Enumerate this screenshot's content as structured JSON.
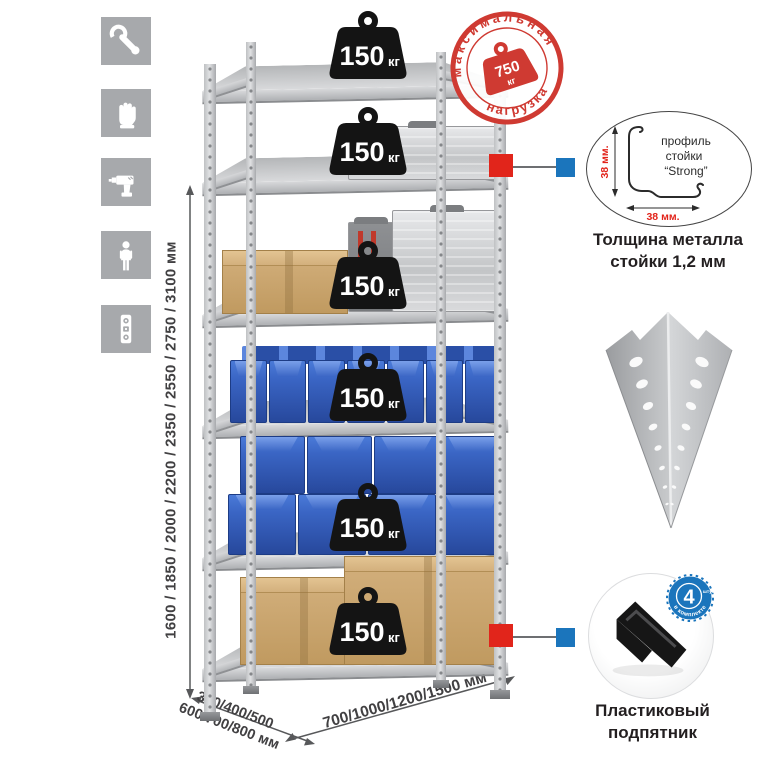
{
  "colors": {
    "accent_red": "#cf3a32",
    "marker_red": "#e1251b",
    "marker_blue": "#1b75bc",
    "bin_blue": "#3a65c4",
    "tile_gray": "#a7a9ac",
    "metal_gray": "#c7c8ca"
  },
  "sidebar_icons": {
    "items": [
      {
        "icon": "wrench"
      },
      {
        "icon": "gloves"
      },
      {
        "icon": "drill"
      },
      {
        "icon": "person"
      },
      {
        "icon": "level"
      }
    ]
  },
  "height_dimension": {
    "label": "1600 / 1850 / 2000 / 2200 / 2350 / 2550 / 2750 / 3100 мм"
  },
  "depth_dimension": {
    "line1": "300/400/500",
    "line2": "600/700/800 мм"
  },
  "width_dimension": {
    "label": "700/1000/1200/1500 мм"
  },
  "max_load_stamp": {
    "arc_top": "максимальная",
    "arc_bottom": "нагрузка",
    "value": "750",
    "unit": "кг"
  },
  "shelving": {
    "shelves": [
      {
        "load": "150",
        "unit": "кг"
      },
      {
        "load": "150",
        "unit": "кг"
      },
      {
        "load": "150",
        "unit": "кг"
      },
      {
        "load": "150",
        "unit": "кг"
      },
      {
        "load": "150",
        "unit": "кг"
      },
      {
        "load": "150",
        "unit": "кг"
      }
    ]
  },
  "profile_detail": {
    "line1": "профиль",
    "line2": "стойки",
    "line3": "“Strong”",
    "vertical_dim": "38 мм.",
    "horizontal_dim": "38 мм.",
    "caption_line1": "Толщина металла",
    "caption_line2": "стойки 1,2 мм"
  },
  "foot_detail": {
    "badge_value": "4",
    "badge_small_text": "штуки",
    "badge_arc": "в комплекте",
    "caption_line1": "Пластиковый",
    "caption_line2": "подпятник"
  }
}
